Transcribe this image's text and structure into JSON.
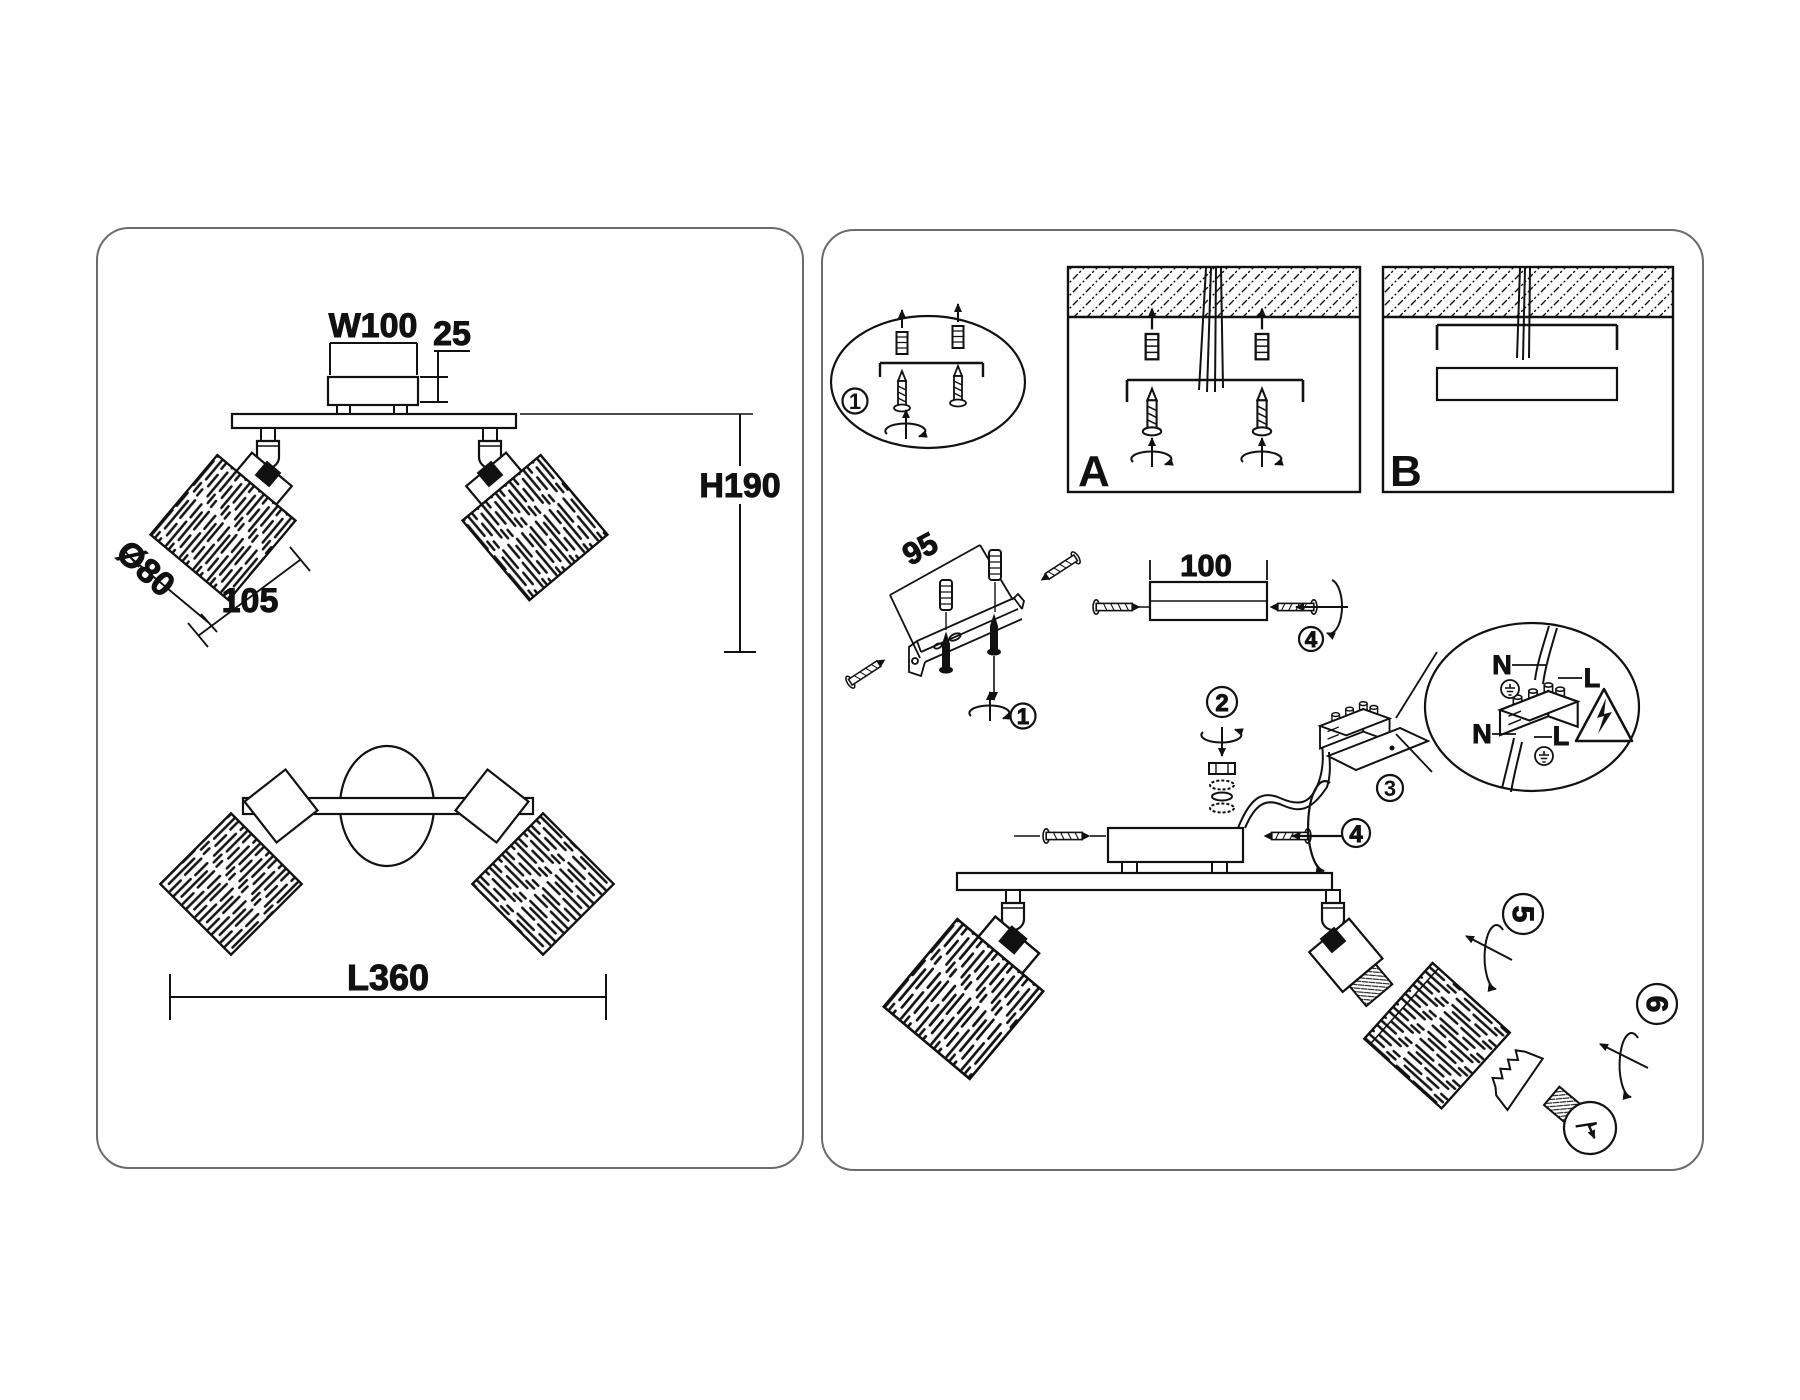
{
  "colors": {
    "ink": "#111111",
    "panel_border": "#6b6b6b",
    "background": "#ffffff"
  },
  "left_panel": {
    "dimensions": {
      "canopy_width": "W100",
      "canopy_height": "25",
      "fixture_height": "H190",
      "shade_diameter": "Ø80",
      "shade_length": "105",
      "fixture_length": "L360"
    }
  },
  "right_panel": {
    "variant_labels": {
      "a": "A",
      "b": "B"
    },
    "dimensions": {
      "bracket_length": "95",
      "canopy_width": "100"
    },
    "steps": {
      "s1": "1",
      "s1_bracket": "1",
      "s2": "2",
      "s3": "3",
      "s4": "4",
      "s4_canopy": "4",
      "s5": "5",
      "s6": "6"
    },
    "wiring": {
      "neutral_top": "N",
      "live_top": "L",
      "neutral_bottom": "N",
      "live_bottom": "L"
    }
  }
}
